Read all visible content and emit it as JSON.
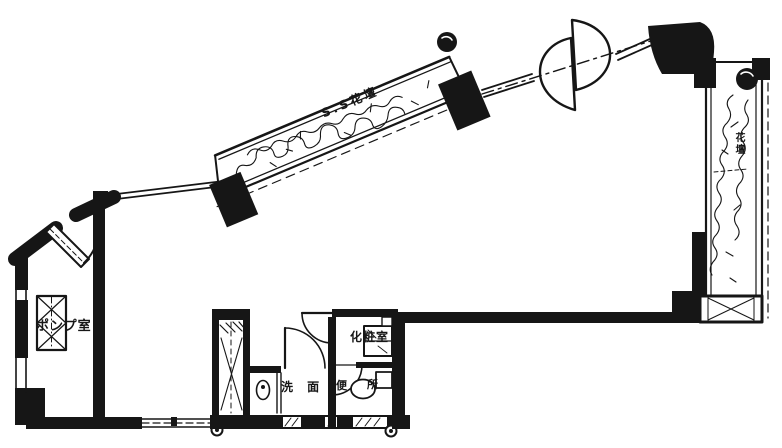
{
  "drawing": {
    "kind": "architectural floor plan (black and white line drawing)",
    "colors": {
      "ink": "#161616",
      "paper": "#ffffff"
    }
  },
  "labels": {
    "pump_room": "ポンプ室",
    "diagonal_planter": "S.S花壇",
    "right_planter": "花壇",
    "powder_room": "化粧室",
    "washroom": "洗 面",
    "toilet_char_1": "便",
    "toilet_char_2": "所"
  }
}
